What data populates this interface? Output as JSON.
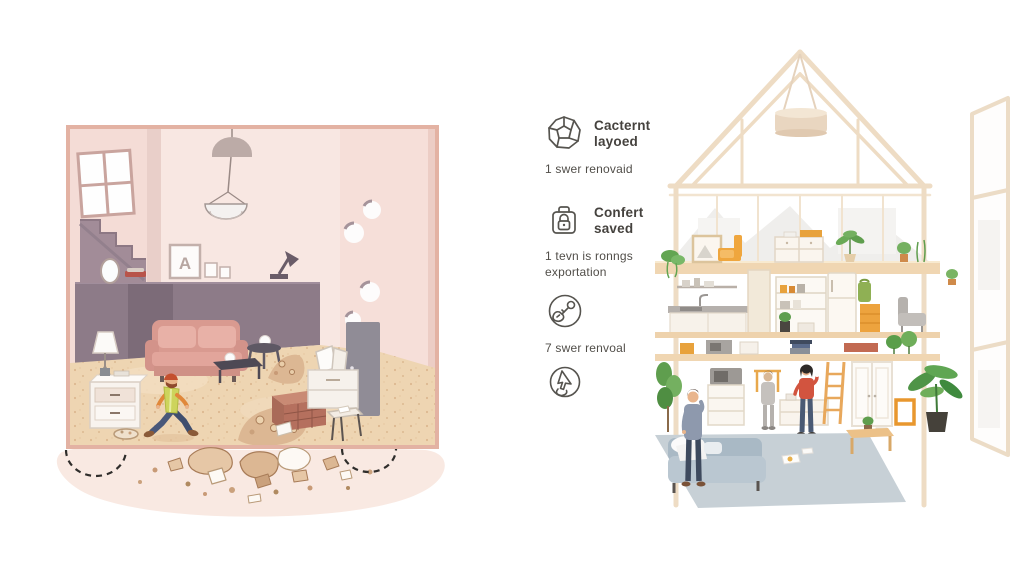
{
  "palette": {
    "background": "#ffffff",
    "text_dark": "#45423e",
    "text_sub": "#514e49",
    "icon_stroke": "#56544f",
    "left_frame_salmon": "#e3b2a3",
    "left_wall_pink": "#f8e7e2",
    "left_dark_mauve": "#8d7b88",
    "left_floor_sand": "#eed5b2",
    "sofa_pink": "#d99a90",
    "worker_vest_yellow": "#cdd45c",
    "worker_cap_orange": "#c4502e",
    "right_beam_beige": "#eedcc4",
    "right_floor_wood": "#f0d6b2",
    "accent_orange": "#eda33e",
    "plant_green": "#5f9e4e",
    "rug_blue_gray": "#c7d0d6",
    "right_sofa_blue": "#bac7d1",
    "woman_top_red": "#d2543f"
  },
  "left_illustration": {
    "frame_letter": "A"
  },
  "features": [
    {
      "icon": "gem-icon",
      "title": "Cacternt\nlayoed",
      "subtitle": "1 swer renovaid"
    },
    {
      "icon": "padlock-icon",
      "title": "Confert\nsaved",
      "subtitle": "1 tevn is ronngs\nexportation"
    },
    {
      "icon": "hand-key-icon",
      "title": "",
      "subtitle": "7 swer renvoal"
    },
    {
      "icon": "cursor-click-icon",
      "title": "",
      "subtitle": ""
    }
  ]
}
